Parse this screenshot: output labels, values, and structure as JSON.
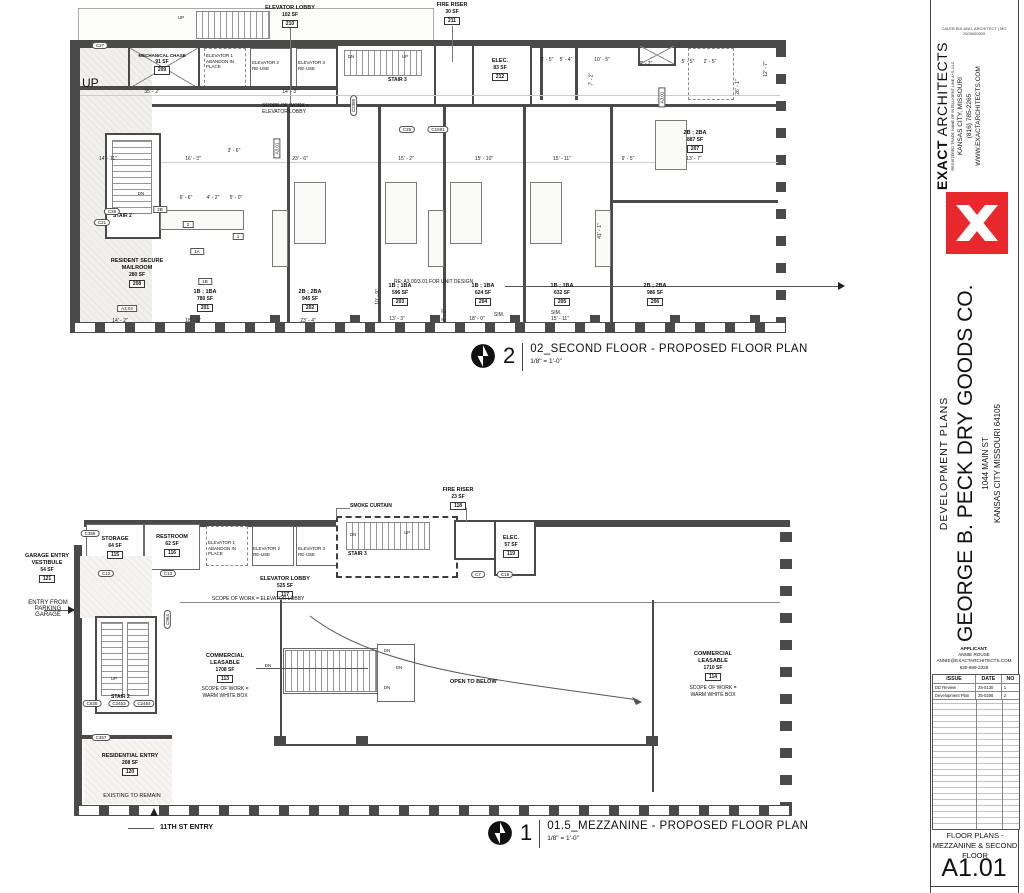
{
  "sheet": {
    "architect_note": "CALEB BULAND, ARCHITECT | MO 2009000509",
    "firm": {
      "name_bold": "EXACT",
      "name_rest": " ARCHITECTS",
      "tagline": "REGISTERED TRADE NAME OF INTELLIGENT LINE A+S, LLC",
      "city": "KANSAS CITY, MISSOURI",
      "phone": "(816) 785-2265",
      "web": "WWW.EXACTARCHITECTS.COM",
      "logo_color": "#e8282c"
    },
    "project": {
      "type": "DEVELOPMENT PLANS",
      "name": "GEORGE B. PECK DRY GOODS CO.",
      "address1": "1044 MAIN ST",
      "address2": "KANSAS CITY MISSOURI 64105"
    },
    "applicant": {
      "label": "APPLICANT:",
      "name": "ANNIE ROUSE",
      "email": "ANNIE@EXACTARCHITECTS.COM",
      "phone": "630-699-2329"
    },
    "issue_table": {
      "headers": [
        "ISSUE",
        "DATE",
        "NO"
      ],
      "rows": [
        {
          "issue": "DD Review",
          "date": "25-0130",
          "no": "1"
        },
        {
          "issue": "Development Plan",
          "date": "25-0206",
          "no": "2"
        }
      ]
    },
    "sheet_title": "FLOOR PLANS - MEZZANINE & SECOND FLOOR",
    "sheet_number": "A1.01"
  },
  "shared": {
    "up": "UP",
    "dn": "DN",
    "stair2": "STAIR 2",
    "stair3": "STAIR 3",
    "elevators": [
      "ELEVATOR 1\nABANDON IN\nPLACE",
      "ELEVATOR 2\nRE-USE",
      "ELEVATOR 3\nRE-USE"
    ]
  },
  "second_floor": {
    "number": "2",
    "title": "02_SECOND FLOOR - PROPOSED FLOOR PLAN",
    "scale": "1/8\" = 1'-0\"",
    "rooms": {
      "mailroom": {
        "name": "RESIDENT SECURE\nMAILROOM",
        "sf": "280 SF",
        "num": "208"
      },
      "mech": {
        "name": "MECHANICAL CHASE",
        "sf": "91 SF",
        "num": "209"
      },
      "lobby": {
        "name": "ELEVATOR LOBBY",
        "sf": "102 SF",
        "num": "210"
      },
      "fire": {
        "name": "FIRE RISER",
        "sf": "30 SF",
        "num": "211"
      },
      "elec": {
        "name": "ELEC.",
        "sf": "83 SF",
        "num": "212"
      }
    },
    "units": [
      {
        "type": "1B ; 1BA",
        "sf": "780 SF",
        "num": "201"
      },
      {
        "type": "2B ; 2BA",
        "sf": "945 SF",
        "num": "202"
      },
      {
        "type": "1B ; 1BA",
        "sf": "596 SF",
        "num": "203"
      },
      {
        "type": "1B ; 1BA",
        "sf": "624 SF",
        "num": "204"
      },
      {
        "type": "1B ; 1BA",
        "sf": "632 SF",
        "num": "205"
      },
      {
        "type": "2B ; 2BA",
        "sf": "986 SF",
        "num": "206"
      },
      {
        "type": "2B ; 2BA",
        "sf": "887 SF",
        "num": "207"
      }
    ],
    "notes": {
      "scope_lobby": "SCOPE OF WORK =\nELEVATOR LOBBY",
      "re_unit": "RE: A3.00/3.01 FOR UNIT DESIGN",
      "up_big": "UP"
    },
    "dims": [
      {
        "t": "35' - 2\"",
        "x": 152,
        "y": 89
      },
      {
        "t": "14' - 3\"",
        "x": 290,
        "y": 89
      },
      {
        "t": "5' - 5\"",
        "x": 547,
        "y": 57
      },
      {
        "t": "5' - 4\"",
        "x": 566,
        "y": 57
      },
      {
        "t": "10' - 5\"",
        "x": 602,
        "y": 57
      },
      {
        "t": "9' - 2\"",
        "x": 646,
        "y": 61
      },
      {
        "t": "5' - 5\"",
        "x": 688,
        "y": 59
      },
      {
        "t": "2' - 5\"",
        "x": 710,
        "y": 59
      },
      {
        "t": "7' - 2\"",
        "x": 585,
        "y": 76,
        "r": 1
      },
      {
        "t": "12' - 7\"",
        "x": 758,
        "y": 66,
        "r": 1
      },
      {
        "t": "26' - 1\"",
        "x": 730,
        "y": 84,
        "r": 1
      },
      {
        "t": "14' - 11\"",
        "x": 108,
        "y": 156
      },
      {
        "t": "16' - 3\"",
        "x": 193,
        "y": 156
      },
      {
        "t": "23' - 6\"",
        "x": 300,
        "y": 156
      },
      {
        "t": "15' - 2\"",
        "x": 406,
        "y": 156
      },
      {
        "t": "15' - 10\"",
        "x": 484,
        "y": 156
      },
      {
        "t": "15' - 11\"",
        "x": 562,
        "y": 156
      },
      {
        "t": "9' - 5\"",
        "x": 628,
        "y": 156
      },
      {
        "t": "13' - 7\"",
        "x": 694,
        "y": 156
      },
      {
        "t": "3' - 6\"",
        "x": 234,
        "y": 148
      },
      {
        "t": "6' - 6\"",
        "x": 186,
        "y": 195
      },
      {
        "t": "4' - 2\"",
        "x": 213,
        "y": 195
      },
      {
        "t": "5' - 0\"",
        "x": 236,
        "y": 195
      },
      {
        "t": "41' - 1\"",
        "x": 592,
        "y": 228,
        "r": 1
      },
      {
        "t": "10' - 9\"",
        "x": 370,
        "y": 294,
        "r": 1
      },
      {
        "t": "14' - 2\"",
        "x": 120,
        "y": 318
      },
      {
        "t": "18' - 3\"",
        "x": 193,
        "y": 318
      },
      {
        "t": "23' - 4\"",
        "x": 308,
        "y": 318
      },
      {
        "t": "13' - 3\"",
        "x": 397,
        "y": 316
      },
      {
        "t": "2' - 2\"",
        "x": 438,
        "y": 312,
        "r": 1
      },
      {
        "t": "18' - 0\"",
        "x": 477,
        "y": 316
      },
      {
        "t": "SIM.",
        "x": 499,
        "y": 312
      },
      {
        "t": "15' - 11\"",
        "x": 560,
        "y": 316
      },
      {
        "t": "SIM.",
        "x": 556,
        "y": 310
      }
    ],
    "tags": [
      {
        "t": "C27",
        "x": 100,
        "y": 42
      },
      {
        "t": "C26",
        "x": 112,
        "y": 208
      },
      {
        "t": "C21",
        "x": 102,
        "y": 219
      },
      {
        "t": "C2385",
        "x": 343,
        "y": 102,
        "r": 1
      },
      {
        "t": "C25",
        "x": 407,
        "y": 126
      },
      {
        "t": "C1591",
        "x": 438,
        "y": 126
      },
      {
        "t": "A3.01",
        "x": 652,
        "y": 94,
        "r": 1,
        "sq": 1
      },
      {
        "t": "A3.01",
        "x": 267,
        "y": 145,
        "r": 1,
        "sq": 1
      },
      {
        "t": "A3.03",
        "x": 127,
        "y": 305,
        "sq": 1
      },
      {
        "t": "2B",
        "x": 160,
        "y": 206,
        "sq": 1
      },
      {
        "t": "2",
        "x": 188,
        "y": 221,
        "sq": 1
      },
      {
        "t": "1",
        "x": 238,
        "y": 233,
        "sq": 1
      },
      {
        "t": "1A",
        "x": 197,
        "y": 248,
        "sq": 1
      },
      {
        "t": "1B",
        "x": 205,
        "y": 278,
        "sq": 1
      }
    ],
    "small_labels": [
      {
        "t": "UP",
        "x": 181,
        "y": 15
      },
      {
        "t": "DN",
        "x": 351,
        "y": 54
      },
      {
        "t": "UP",
        "x": 405,
        "y": 54
      },
      {
        "t": "DN",
        "x": 141,
        "y": 191
      }
    ]
  },
  "mezzanine": {
    "number": "1",
    "title": "01.5_MEZZANINE - PROPOSED FLOOR PLAN",
    "scale": "1/8\" = 1'-0\"",
    "rooms": {
      "storage": {
        "name": "STORAGE",
        "sf": "64 SF",
        "num": "115"
      },
      "restroom": {
        "name": "RESTROOM",
        "sf": "62 SF",
        "num": "116"
      },
      "lobby": {
        "name": "ELEVATOR LOBBY",
        "sf": "525 SF",
        "num": "117"
      },
      "fire": {
        "name": "FIRE RISER",
        "sf": "23 SF",
        "num": "118"
      },
      "elec": {
        "name": "ELEC.",
        "sf": "57 SF",
        "num": "119"
      },
      "res_entry": {
        "name": "RESIDENTIAL ENTRY",
        "sf": "208 SF",
        "num": "120"
      },
      "vestibule": {
        "name": "GARAGE ENTRY\nVESTIBULE",
        "sf": "54 SF",
        "num": "121"
      },
      "comm113": {
        "name": "COMMERCIAL\nLEASABLE",
        "sf": "1708 SF",
        "num": "113"
      },
      "comm114": {
        "name": "COMMERCIAL\nLEASABLE",
        "sf": "1710 SF",
        "num": "114"
      }
    },
    "notes": {
      "smoke": "SMOKE CURTAIN",
      "open": "OPEN TO BELOW",
      "scope_lobby": "SCOPE OF WORK = ELEVATOR LOBBY",
      "scope_wwb": "SCOPE OF WORK =\nWARM WHITE BOX",
      "entry_garage": "ENTRY FROM\nPARKING\nGARAGE",
      "existing": "EXISTING TO REMAIN",
      "st11": "11TH ST ENTRY"
    },
    "tags": [
      {
        "t": "C359",
        "x": 90,
        "y": 530
      },
      {
        "t": "C12",
        "x": 106,
        "y": 570
      },
      {
        "t": "C13",
        "x": 168,
        "y": 570
      },
      {
        "t": "C964",
        "x": 158,
        "y": 616,
        "r": 1
      },
      {
        "t": "C635",
        "x": 92,
        "y": 700
      },
      {
        "t": "C2453",
        "x": 119,
        "y": 700
      },
      {
        "t": "C2454",
        "x": 144,
        "y": 700
      },
      {
        "t": "C357",
        "x": 101,
        "y": 734
      },
      {
        "t": "C7",
        "x": 478,
        "y": 571
      },
      {
        "t": "C18",
        "x": 505,
        "y": 571
      }
    ],
    "small_labels": [
      {
        "t": "DN",
        "x": 353,
        "y": 532
      },
      {
        "t": "UP",
        "x": 407,
        "y": 530
      },
      {
        "t": "UP",
        "x": 114,
        "y": 676
      },
      {
        "t": "DN",
        "x": 268,
        "y": 663
      },
      {
        "t": "DN",
        "x": 387,
        "y": 648
      },
      {
        "t": "DN",
        "x": 399,
        "y": 665
      },
      {
        "t": "DN",
        "x": 387,
        "y": 685
      }
    ]
  }
}
